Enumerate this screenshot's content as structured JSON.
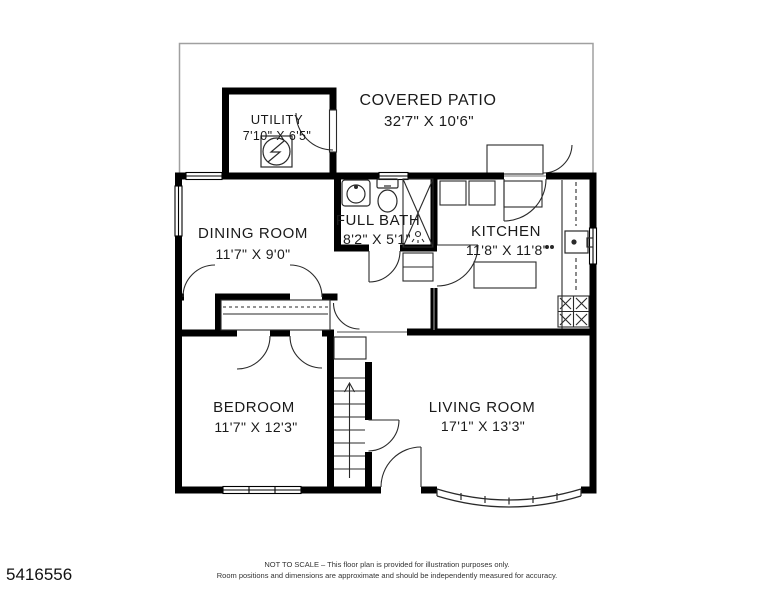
{
  "title": "Floor plan",
  "rooms": [
    {
      "name": "COVERED PATIO",
      "dimensions": "32'7\" X 10'6\""
    },
    {
      "name": "UTILITY",
      "dimensions": "7'10\" X 6'5\""
    },
    {
      "name": "DINING ROOM",
      "dimensions": "11'7\" X 9'0\""
    },
    {
      "name": "FULL BATH",
      "dimensions": "8'2\" X 5'1\""
    },
    {
      "name": "KITCHEN",
      "dimensions": "11'8\" X 11'8\""
    },
    {
      "name": "BEDROOM",
      "dimensions": "11'7\" X 12'3\""
    },
    {
      "name": "LIVING ROOM",
      "dimensions": "17'1\" X 13'3\""
    }
  ],
  "fixtures": [
    "water-heater",
    "bath-sink",
    "toilet",
    "shower",
    "kitchen-sink",
    "stove",
    "kitchen-island",
    "stairs-up",
    "bay-window",
    "closet"
  ],
  "stairs_direction": "up",
  "footer": {
    "mls_number": "5416556",
    "disclaimer_line1": "NOT TO SCALE – This floor plan is provided for illustration purposes only.",
    "disclaimer_line2": "Room positions and dimensions are approximate and should be independently measured for accuracy."
  },
  "colors": {
    "wall": "#000000",
    "patio_outline": "#a0a0a0",
    "fixture_line": "#2a2a2a",
    "text": "#1a1a1a",
    "background": "#ffffff"
  }
}
